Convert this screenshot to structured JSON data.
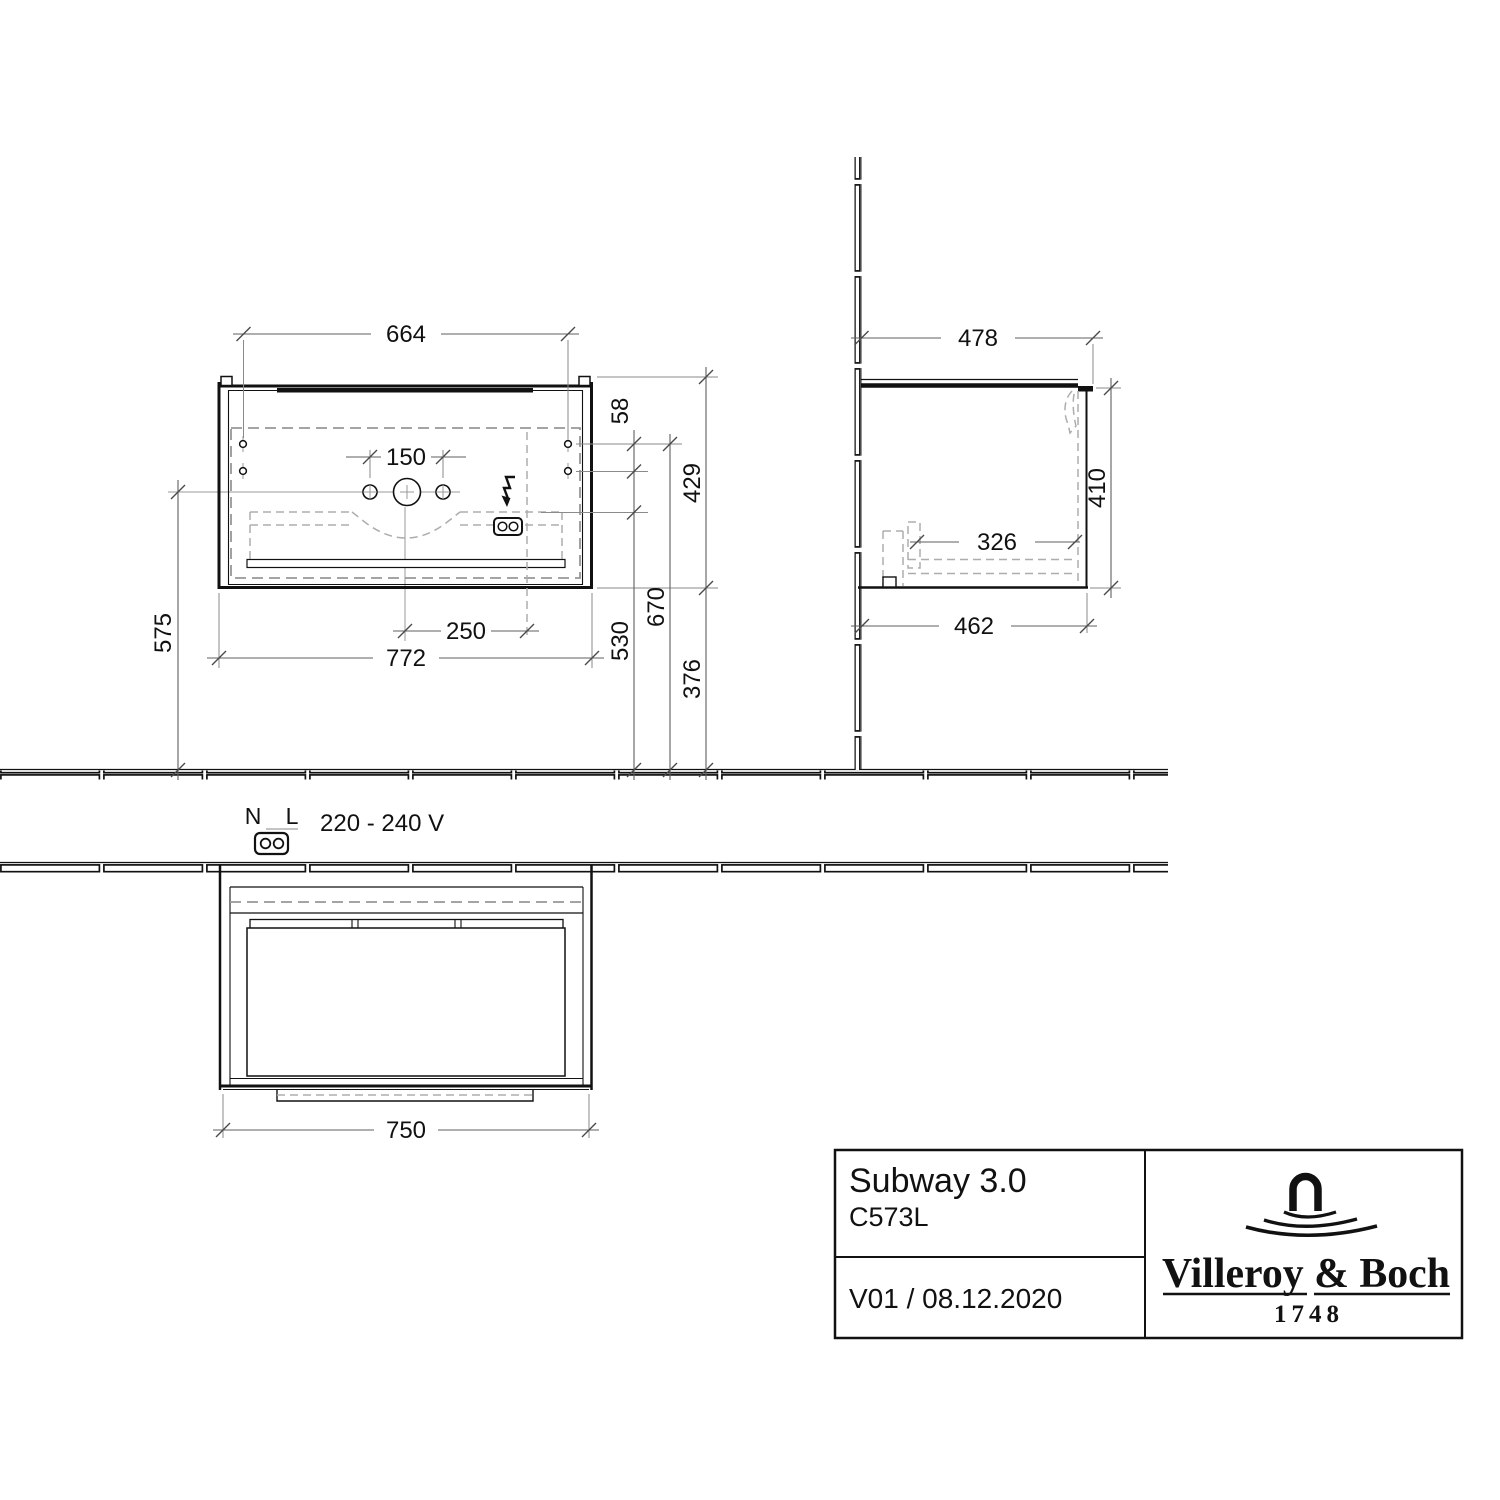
{
  "dims": {
    "plan": {
      "hole_span": "664",
      "tap_holes": "150",
      "outlet_offset": "250",
      "width": "772",
      "center_to_wall": "575",
      "hole_rows": "58",
      "depth": "429",
      "outlet_to_wall": "530",
      "holes_to_wall": "670",
      "front_to_wall": "376"
    },
    "side": {
      "depth_top": "478",
      "height": "410",
      "inner_depth": "326",
      "depth_bottom": "462"
    },
    "front": {
      "width": "750"
    }
  },
  "electrical": {
    "n": "N",
    "l": "L",
    "voltage": "220 - 240 V"
  },
  "title_block": {
    "series": "Subway 3.0",
    "article": "C573L",
    "revision": "V01 / 08.12.2020",
    "brand": "Villeroy & Boch",
    "year": "1748"
  },
  "colors": {
    "line": "#111111",
    "dashed": "#9a9a9a",
    "background": "#ffffff"
  }
}
